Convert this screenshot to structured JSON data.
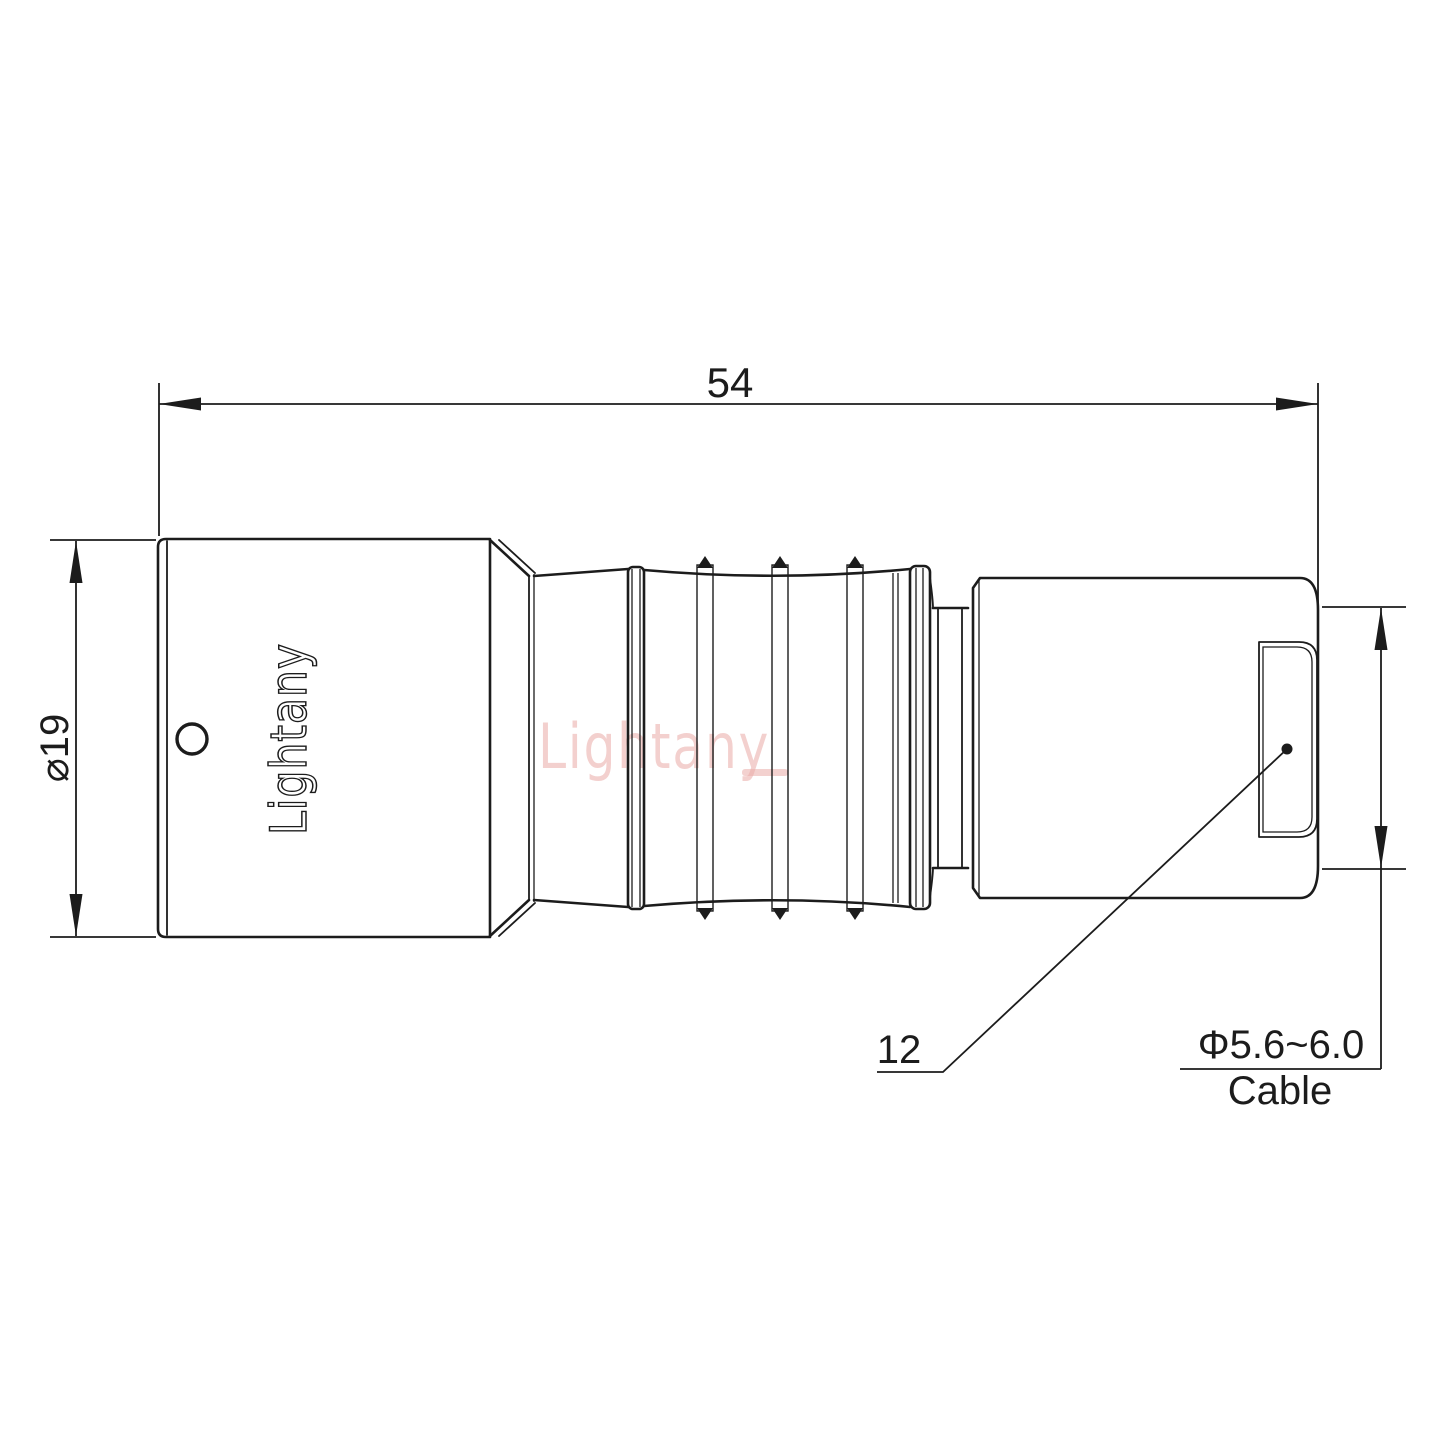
{
  "drawing": {
    "length_dim": "54",
    "body_diameter_dim": "⌀19",
    "rear_dim": "12",
    "cable_diameter_dim": "Φ5.6~6.0",
    "cable_word": "Cable",
    "body_engraving": "Lightany",
    "watermark_text": "Lightany",
    "colors": {
      "line": "#1c1c1c",
      "watermark": "#eaaba7"
    }
  }
}
